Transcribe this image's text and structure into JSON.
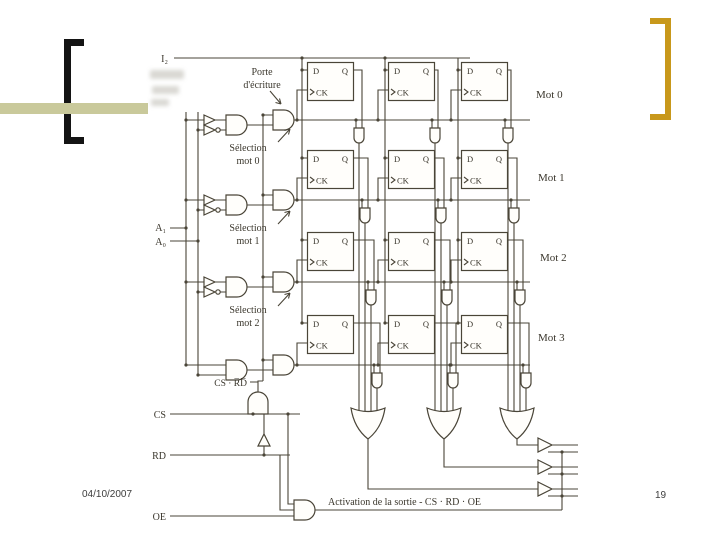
{
  "slide": {
    "footer": {
      "date": "04/10/2007",
      "page_number": "19"
    }
  },
  "decorations": {
    "left_bracket": "[",
    "right_bracket": "]",
    "left_bracket_color": "#141414",
    "right_bracket_color": "#C8981B",
    "accent_bar_color": "#C9C99B"
  },
  "diagram": {
    "stroke_color": "#4a4538",
    "input_label": "I₂",
    "address_labels": [
      "A₁",
      "A₀"
    ],
    "control_labels": {
      "cs": "CS",
      "rd": "RD",
      "oe": "OE"
    },
    "write_gate_label": {
      "line1": "Porte",
      "line2": "d'écriture"
    },
    "selection_labels": [
      {
        "line1": "Sélection",
        "line2": "mot 0"
      },
      {
        "line1": "Sélection",
        "line2": "mot 1"
      },
      {
        "line1": "Sélection",
        "line2": "mot 2"
      }
    ],
    "word_labels": [
      "Mot 0",
      "Mot 1",
      "Mot 2",
      "Mot 3"
    ],
    "flipflop_labels": {
      "d": "D",
      "q": "Q",
      "ck": "CK"
    },
    "write_enable_label": "CS · R̅D̅",
    "activation_label": "Activation de la sortie - CS · RD · OE"
  }
}
